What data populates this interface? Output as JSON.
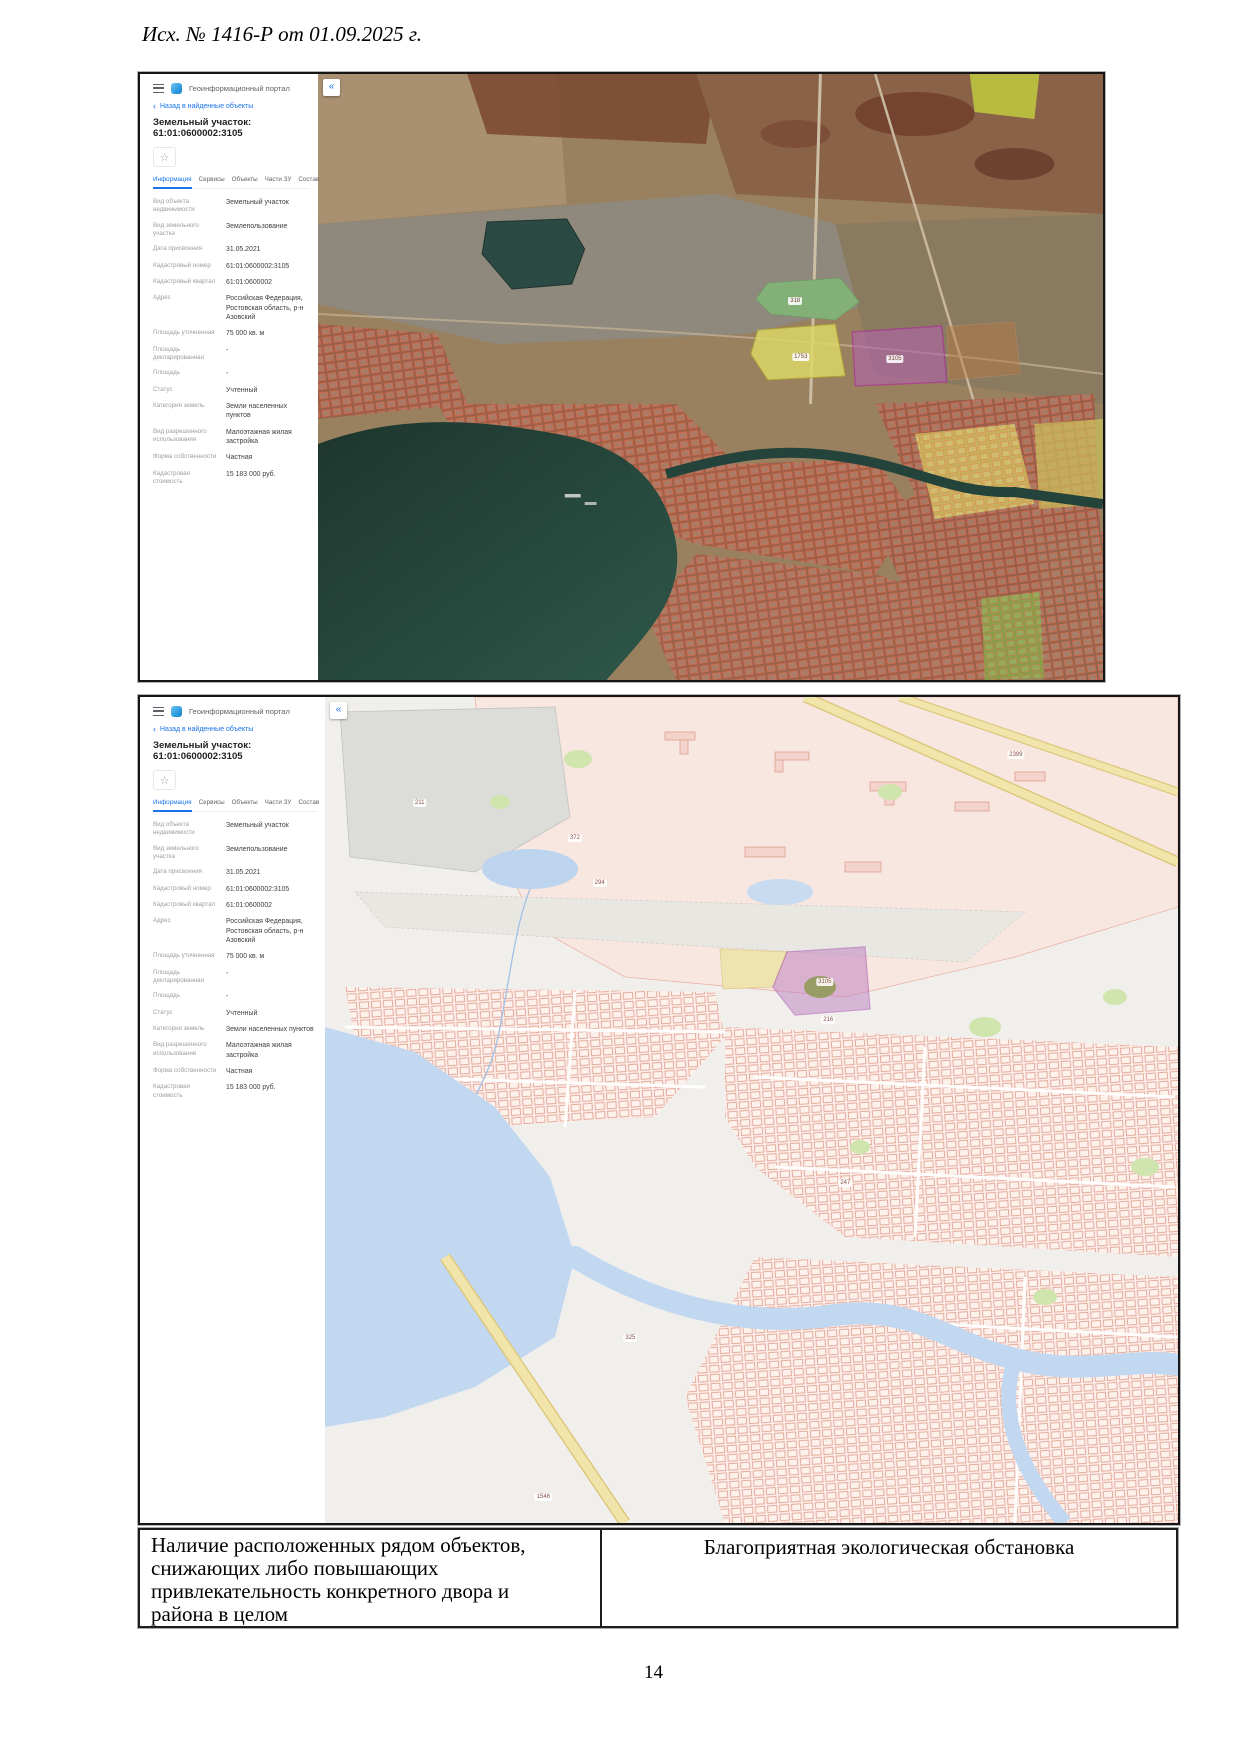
{
  "document": {
    "header_ref": "Исх. № 1416-Р от 01.09.2025 г.",
    "page_number": "14",
    "table": {
      "left_cell": "Наличие расположенных рядом объектов, снижающих либо повышающих привлекательность конкретного двора и района в целом",
      "right_cell": "Благоприятная экологическая обстановка"
    }
  },
  "gis_panel": {
    "app_title": "Геоинформационный портал",
    "back_link": "Назад в найденные объекты",
    "object_title": "Земельный участок: 61:01:0600002:3105",
    "tabs": [
      "Информация",
      "Сервисы",
      "Объекты",
      "Части ЗУ",
      "Состав"
    ],
    "active_tab": "Информация",
    "icons": {
      "back": "‹",
      "star": "☆",
      "add_tab": "+",
      "collapse": "«"
    },
    "fields": [
      {
        "label": "Вид объекта недвижимости",
        "value": "Земельный участок"
      },
      {
        "label": "Вид земельного участка",
        "value": "Землепользование"
      },
      {
        "label": "Дата присвоения",
        "value": "31.05.2021"
      },
      {
        "label": "Кадастровый номер",
        "value": "61:01:0600002:3105"
      },
      {
        "label": "Кадастровый квартал",
        "value": "61:01:0600002"
      },
      {
        "label": "Адрес",
        "value": "Российская Федерация, Ростовская область, р-н Азовский"
      },
      {
        "label": "Площадь уточненная",
        "value": "75 000 кв. м"
      },
      {
        "label": "Площадь декларированная",
        "value": "-"
      },
      {
        "label": "Площадь",
        "value": "-"
      },
      {
        "label": "Статус",
        "value": "Учтенный"
      },
      {
        "label": "Категория земель",
        "value": "Земли населенных пунктов"
      },
      {
        "label": "Вид разрешенного использования",
        "value": "Малоэтажная жилая застройка"
      },
      {
        "label": "Форма собственности",
        "value": "Частная"
      },
      {
        "label": "Кадастровая стоимость",
        "value": "15 183 000 руб."
      }
    ]
  },
  "maps": {
    "satellite": {
      "kind": "satellite imagery with cadastral overlay",
      "selected_parcel": "3105",
      "labels": [
        {
          "text": "318",
          "x": 60.8,
          "y": 37.5
        },
        {
          "text": "1753",
          "x": 61.5,
          "y": 46.7
        },
        {
          "text": "3105",
          "x": 73.5,
          "y": 47.0
        }
      ]
    },
    "schematic": {
      "kind": "cadastral scheme map",
      "selected_parcel": "3105",
      "labels": [
        {
          "text": "211",
          "x": 11.1,
          "y": 12.8
        },
        {
          "text": "372",
          "x": 29.3,
          "y": 17.1
        },
        {
          "text": "294",
          "x": 32.2,
          "y": 22.5
        },
        {
          "text": "2399",
          "x": 81.0,
          "y": 7.0
        },
        {
          "text": "3105",
          "x": 58.6,
          "y": 34.5
        },
        {
          "text": "216",
          "x": 59.0,
          "y": 39.1
        },
        {
          "text": "247",
          "x": 61.0,
          "y": 58.8
        },
        {
          "text": "325",
          "x": 35.8,
          "y": 77.6
        },
        {
          "text": "1546",
          "x": 25.6,
          "y": 96.8
        }
      ]
    }
  },
  "colors": {
    "accent_blue": "#1a73e8",
    "selected_parcel_stroke": "#b520a8",
    "selected_parcel_fill": "#b263ad",
    "water_satellite": "#2d5246",
    "water_scheme": "#c2d8f1",
    "parcel_pink": "#f8e6e0"
  }
}
